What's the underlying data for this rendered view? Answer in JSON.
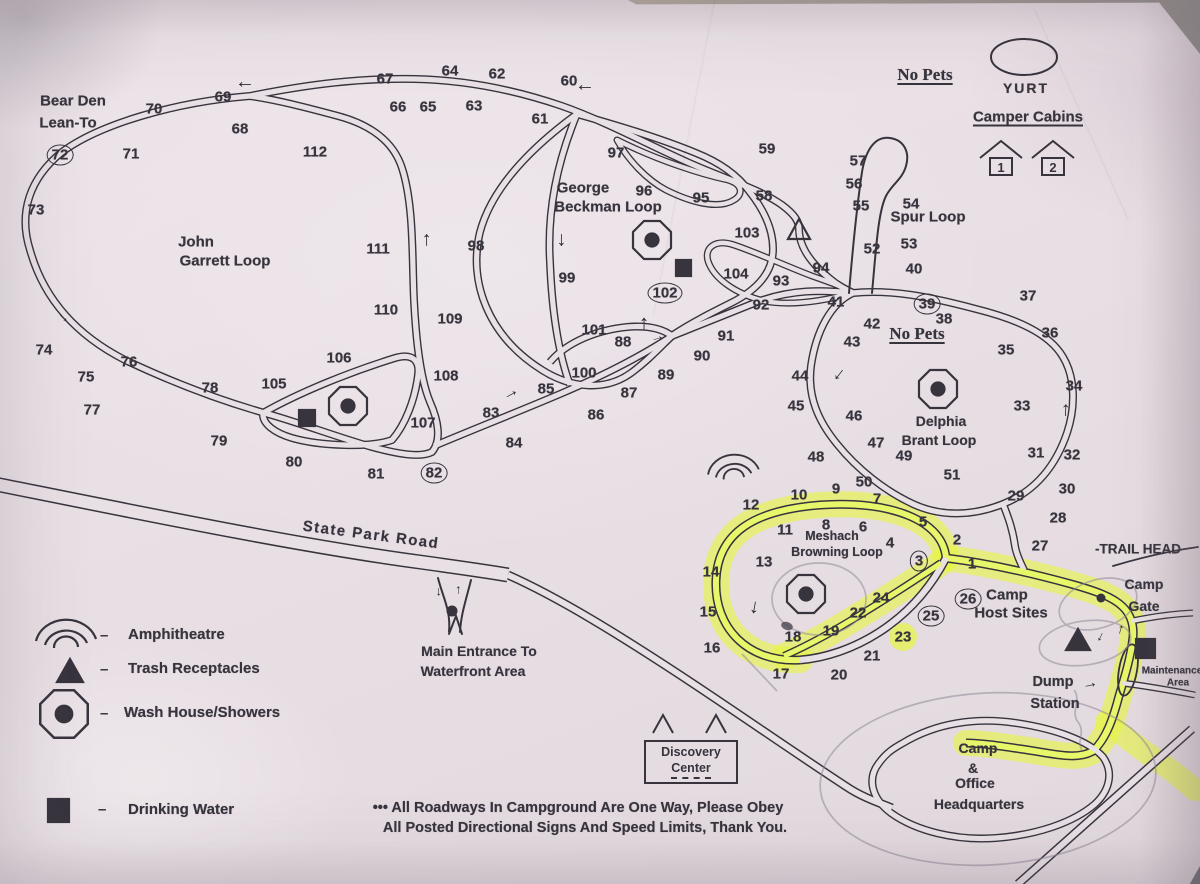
{
  "colors": {
    "paper": "#e9e0e5",
    "ink": "#37343e",
    "highlight": "#e6f542",
    "pencil": "#8f8a97"
  },
  "legend": {
    "dash": "–",
    "items": [
      {
        "icon": "amphitheatre-icon",
        "label": "Amphitheatre"
      },
      {
        "icon": "trash-receptacles-icon",
        "label": "Trash Receptacles"
      },
      {
        "icon": "wash-house-icon",
        "label": "Wash House/Showers"
      },
      {
        "icon": "drinking-water-icon",
        "label": "Drinking Water"
      }
    ]
  },
  "discovery": [
    "Discovery",
    "Center"
  ],
  "cabins": [
    "1",
    "2"
  ],
  "map": {
    "arrow_glyph": "→",
    "labels": [
      {
        "id": "bear-den-1",
        "t": "Bear Den",
        "x": 73,
        "y": 101,
        "s": 15
      },
      {
        "id": "bear-den-2",
        "t": "Lean-To",
        "x": 68,
        "y": 123,
        "s": 15
      },
      {
        "id": "john-garrett-1",
        "t": "John",
        "x": 196,
        "y": 242,
        "s": 15
      },
      {
        "id": "john-garrett-2",
        "t": "Garrett Loop",
        "x": 225,
        "y": 261,
        "s": 15
      },
      {
        "id": "george-beckman-1",
        "t": "George",
        "x": 583,
        "y": 188,
        "s": 15
      },
      {
        "id": "george-beckman-2",
        "t": "Beckman Loop",
        "x": 608,
        "y": 207,
        "s": 15
      },
      {
        "id": "spur-loop",
        "t": "Spur Loop",
        "x": 928,
        "y": 217,
        "s": 15
      },
      {
        "id": "no-pets-north",
        "t": "No Pets",
        "x": 925,
        "y": 75,
        "s": 17,
        "serif": 1,
        "u": 1
      },
      {
        "id": "yurt",
        "t": "YURT",
        "x": 1026,
        "y": 88,
        "s": 14,
        "ls": 2
      },
      {
        "id": "camper-cabins",
        "t": "Camper Cabins",
        "x": 1028,
        "y": 117,
        "s": 15,
        "u": 1
      },
      {
        "id": "no-pets-delphia",
        "t": "No Pets",
        "x": 917,
        "y": 334,
        "s": 17,
        "serif": 1,
        "u": 1
      },
      {
        "id": "delphia-1",
        "t": "Delphia",
        "x": 941,
        "y": 421,
        "s": 14
      },
      {
        "id": "delphia-2",
        "t": "Brant Loop",
        "x": 939,
        "y": 440,
        "s": 14
      },
      {
        "id": "meshach-1",
        "t": "Meshach",
        "x": 832,
        "y": 536,
        "s": 12.5
      },
      {
        "id": "meshach-2",
        "t": "Browning Loop",
        "x": 837,
        "y": 552,
        "s": 12.5
      },
      {
        "id": "camp-host-1",
        "t": "Camp",
        "x": 1007,
        "y": 595,
        "s": 15
      },
      {
        "id": "camp-host-2",
        "t": "Host Sites",
        "x": 1011,
        "y": 613,
        "s": 15
      },
      {
        "id": "trail-head",
        "t": "-TRAIL HEAD",
        "x": 1138,
        "y": 549,
        "s": 13.5
      },
      {
        "id": "camp-gate-1",
        "t": "Camp",
        "x": 1144,
        "y": 584,
        "s": 14
      },
      {
        "id": "camp-gate-2",
        "t": "Gate",
        "x": 1144,
        "y": 606,
        "s": 14
      },
      {
        "id": "maintenance-1",
        "t": "Maintenance",
        "x": 1172,
        "y": 671,
        "s": 10
      },
      {
        "id": "maintenance-2",
        "t": "Area",
        "x": 1178,
        "y": 683,
        "s": 10
      },
      {
        "id": "dump-1",
        "t": "Dump",
        "x": 1053,
        "y": 682,
        "s": 14.5
      },
      {
        "id": "dump-2",
        "t": "Station",
        "x": 1055,
        "y": 704,
        "s": 14.5
      },
      {
        "id": "hq-1",
        "t": "Camp",
        "x": 978,
        "y": 748,
        "s": 14
      },
      {
        "id": "hq-2",
        "t": "&",
        "x": 973,
        "y": 768,
        "s": 14
      },
      {
        "id": "hq-3",
        "t": "Office",
        "x": 975,
        "y": 783,
        "s": 14
      },
      {
        "id": "hq-4",
        "t": "Headquarters",
        "x": 979,
        "y": 804,
        "s": 14
      },
      {
        "id": "state-park-road",
        "t": "State Park Road",
        "x": 371,
        "y": 535,
        "s": 15,
        "r": 7.5,
        "ls": 1.5
      },
      {
        "id": "main-entrance-1",
        "t": "Main Entrance To",
        "x": 479,
        "y": 651,
        "s": 14
      },
      {
        "id": "main-entrance-2",
        "t": "Waterfront Area",
        "x": 473,
        "y": 671,
        "s": 14
      },
      {
        "id": "note-1",
        "t": "••• All Roadways In Campground Are One Way, Please Obey",
        "x": 578,
        "y": 808,
        "s": 14.5
      },
      {
        "id": "note-2",
        "t": "All Posted Directional Signs And Speed Limits, Thank You.",
        "x": 585,
        "y": 828,
        "s": 14.5
      }
    ],
    "sites": [
      [
        67,
        385,
        79
      ],
      [
        64,
        450,
        71
      ],
      [
        62,
        497,
        74
      ],
      [
        60,
        569,
        81
      ],
      [
        66,
        398,
        107
      ],
      [
        65,
        428,
        107
      ],
      [
        63,
        474,
        106
      ],
      [
        61,
        540,
        119
      ],
      [
        70,
        154,
        109
      ],
      [
        69,
        223,
        97
      ],
      [
        68,
        240,
        129
      ],
      [
        71,
        131,
        154
      ],
      [
        112,
        315,
        152
      ],
      [
        72,
        60,
        155,
        1
      ],
      [
        73,
        36,
        210
      ],
      [
        111,
        378,
        249
      ],
      [
        110,
        386,
        310
      ],
      [
        109,
        450,
        319
      ],
      [
        98,
        476,
        246
      ],
      [
        99,
        567,
        278
      ],
      [
        97,
        616,
        153
      ],
      [
        96,
        644,
        191
      ],
      [
        95,
        701,
        198
      ],
      [
        59,
        767,
        149
      ],
      [
        58,
        764,
        196
      ],
      [
        103,
        747,
        233
      ],
      [
        104,
        736,
        274
      ],
      [
        93,
        781,
        281
      ],
      [
        92,
        761,
        305
      ],
      [
        91,
        726,
        336
      ],
      [
        90,
        702,
        356
      ],
      [
        101,
        594,
        330
      ],
      [
        88,
        623,
        342
      ],
      [
        102,
        665,
        293,
        1
      ],
      [
        100,
        584,
        373
      ],
      [
        85,
        546,
        389
      ],
      [
        87,
        629,
        393
      ],
      [
        89,
        666,
        375
      ],
      [
        86,
        596,
        415
      ],
      [
        83,
        491,
        413
      ],
      [
        84,
        514,
        443
      ],
      [
        74,
        44,
        350
      ],
      [
        76,
        129,
        362
      ],
      [
        75,
        86,
        377
      ],
      [
        78,
        210,
        388
      ],
      [
        77,
        92,
        410
      ],
      [
        105,
        274,
        384
      ],
      [
        106,
        339,
        358
      ],
      [
        108,
        446,
        376
      ],
      [
        107,
        423,
        423
      ],
      [
        79,
        219,
        441
      ],
      [
        80,
        294,
        462
      ],
      [
        81,
        376,
        474
      ],
      [
        82,
        434,
        473,
        1
      ],
      [
        57,
        858,
        161
      ],
      [
        56,
        854,
        184
      ],
      [
        55,
        861,
        206
      ],
      [
        54,
        911,
        204
      ],
      [
        53,
        909,
        244
      ],
      [
        52,
        872,
        249
      ],
      [
        40,
        914,
        269
      ],
      [
        94,
        821,
        268
      ],
      [
        41,
        836,
        302
      ],
      [
        42,
        872,
        324
      ],
      [
        39,
        927,
        304,
        1
      ],
      [
        37,
        1028,
        296
      ],
      [
        38,
        944,
        319
      ],
      [
        36,
        1050,
        333
      ],
      [
        35,
        1006,
        350
      ],
      [
        43,
        852,
        342
      ],
      [
        44,
        800,
        376
      ],
      [
        34,
        1074,
        386
      ],
      [
        33,
        1022,
        406
      ],
      [
        45,
        796,
        406
      ],
      [
        46,
        854,
        416
      ],
      [
        47,
        876,
        443
      ],
      [
        49,
        904,
        456
      ],
      [
        31,
        1036,
        453
      ],
      [
        32,
        1072,
        455
      ],
      [
        48,
        816,
        457
      ],
      [
        51,
        952,
        475
      ],
      [
        50,
        864,
        482
      ],
      [
        30,
        1067,
        489
      ],
      [
        29,
        1016,
        496
      ],
      [
        28,
        1058,
        518
      ],
      [
        27,
        1040,
        546
      ],
      [
        12,
        751,
        505
      ],
      [
        10,
        799,
        495
      ],
      [
        9,
        836,
        489
      ],
      [
        7,
        877,
        499
      ],
      [
        8,
        826,
        525
      ],
      [
        6,
        863,
        527
      ],
      [
        5,
        923,
        522
      ],
      [
        11,
        785,
        530
      ],
      [
        4,
        890,
        543
      ],
      [
        2,
        957,
        540
      ],
      [
        1,
        972,
        564
      ],
      [
        3,
        919,
        561,
        1
      ],
      [
        13,
        764,
        562
      ],
      [
        14,
        711,
        572
      ],
      [
        24,
        881,
        598
      ],
      [
        22,
        858,
        613
      ],
      [
        25,
        931,
        616,
        1
      ],
      [
        26,
        968,
        599,
        1
      ],
      [
        15,
        708,
        612
      ],
      [
        19,
        831,
        631
      ],
      [
        18,
        793,
        637
      ],
      [
        23,
        903,
        637
      ],
      [
        16,
        712,
        648
      ],
      [
        21,
        872,
        656
      ],
      [
        17,
        781,
        674
      ],
      [
        20,
        839,
        675
      ]
    ],
    "arrows": [
      [
        245,
        87,
        180,
        20
      ],
      [
        585,
        90,
        180,
        20
      ],
      [
        424,
        240,
        -90,
        20
      ],
      [
        564,
        240,
        90,
        20
      ],
      [
        641,
        324,
        -90,
        21
      ],
      [
        657,
        336,
        -15,
        14
      ],
      [
        510,
        392,
        -28,
        17
      ],
      [
        65,
        316,
        42,
        14
      ],
      [
        841,
        376,
        128,
        19
      ],
      [
        1063,
        410,
        -88,
        20
      ],
      [
        757,
        608,
        100,
        20
      ],
      [
        441,
        592,
        90,
        13
      ],
      [
        456,
        590,
        -90,
        13
      ],
      [
        1090,
        684,
        -12,
        16
      ],
      [
        1103,
        638,
        115,
        14
      ],
      [
        1118,
        629,
        -75,
        14
      ]
    ]
  }
}
